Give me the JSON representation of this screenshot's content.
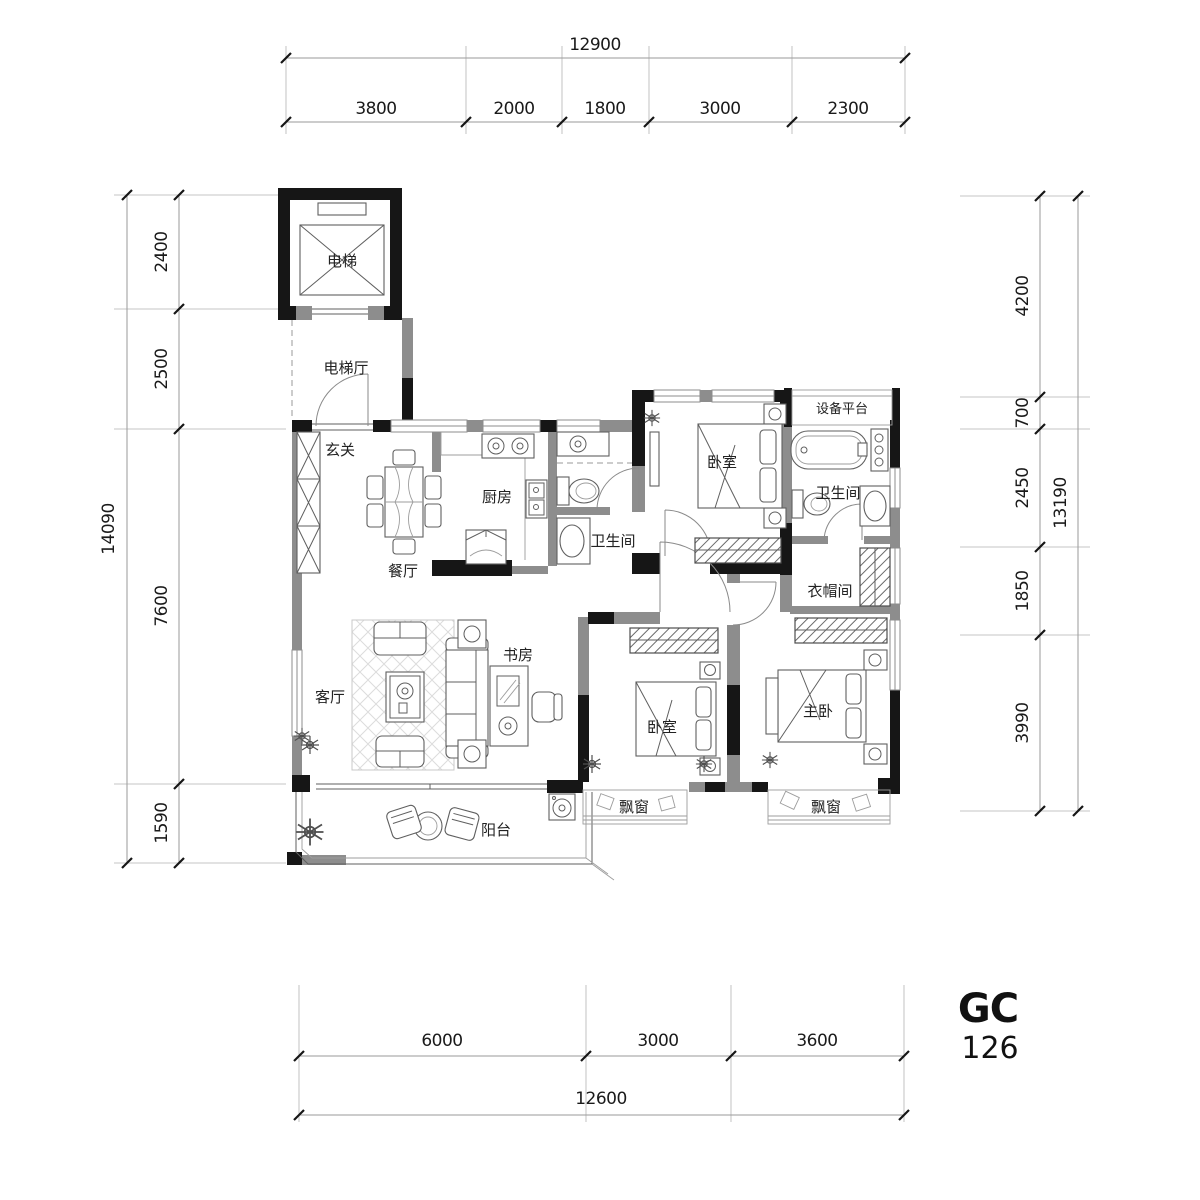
{
  "title": {
    "code": "GC",
    "model": "126"
  },
  "dims": {
    "top": {
      "overall": "12900",
      "segments": [
        "3800",
        "2000",
        "1800",
        "3000",
        "2300"
      ]
    },
    "left": {
      "overall": "14090",
      "segments": [
        "2400",
        "2500",
        "7600",
        "1590"
      ]
    },
    "right": {
      "overall": "13190",
      "segments": [
        "4200",
        "700",
        "2450",
        "1850",
        "3990"
      ]
    },
    "bottom": {
      "overall": "12600",
      "segments": [
        "6000",
        "3000",
        "3600"
      ]
    }
  },
  "rooms": {
    "elevator": "电梯",
    "elevator_hall": "电梯厅",
    "entry": "玄关",
    "dining": "餐厅",
    "kitchen": "厨房",
    "bath_main": "卫生间",
    "bath_master": "卫生间",
    "bedroom_north": "卧室",
    "bedroom_south": "卧室",
    "master_bedroom": "主卧",
    "study": "书房",
    "living": "客厅",
    "cloakroom": "衣帽间",
    "equipment_platform": "设备平台",
    "balcony": "阳台",
    "bay_window_1": "飘窗",
    "bay_window_2": "飘窗"
  },
  "colors": {
    "wall_black": "#161616",
    "wall_gray": "#8d8d8d",
    "furniture_line": "#5f5f5f",
    "dim_line": "#9a9a9a",
    "text": "#1a1a1a"
  }
}
